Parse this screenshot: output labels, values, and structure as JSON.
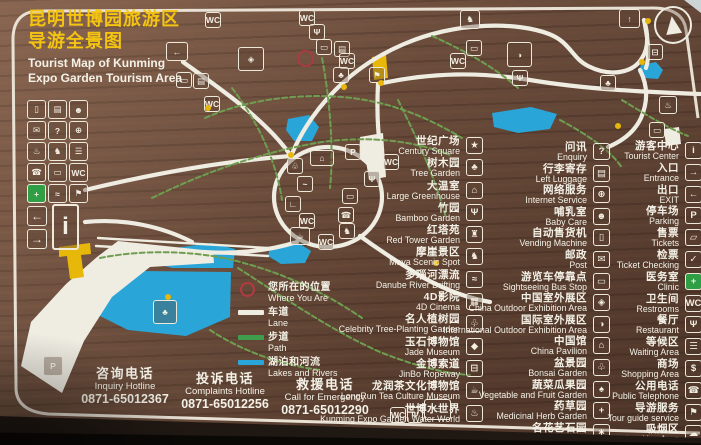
{
  "sign": {
    "title": {
      "zh1": "昆明世博园旅游区",
      "zh2": "导游全景图",
      "en1": "Tourist Map of Kunming",
      "en2": "Expo Garden Tourism Area"
    }
  },
  "legend": {
    "marker": {
      "zh": "您所在的位置",
      "en": "Where You Are"
    },
    "bars": [
      {
        "name": "legend-lane",
        "zh": "车道",
        "en": "Lane",
        "color": "#efece2"
      },
      {
        "name": "legend-path",
        "zh": "步道",
        "en": "Path",
        "color": "#3f9e4b"
      },
      {
        "name": "legend-lakes-rivers",
        "zh": "湖泊和河流",
        "en": "Lakes and Rivers",
        "color": "#2aa5d8"
      }
    ]
  },
  "attractions": [
    {
      "name": "poi-century-square",
      "zh": "世纪广场",
      "en": "Century Square",
      "icon": "century-square-icon",
      "glyph": "★"
    },
    {
      "name": "poi-tree-garden",
      "zh": "树木园",
      "en": "Tree Garden",
      "icon": "tree-icon",
      "glyph": "♣"
    },
    {
      "name": "poi-large-greenhouse",
      "zh": "大温室",
      "en": "Large Greenhouse",
      "icon": "greenhouse-icon",
      "glyph": "⌂"
    },
    {
      "name": "poi-bamboo-garden",
      "zh": "竹园",
      "en": "Bamboo Garden",
      "icon": "bamboo-icon",
      "glyph": "Ψ"
    },
    {
      "name": "poi-red-tower-garden",
      "zh": "红塔苑",
      "en": "Red Tower Garden",
      "icon": "tower-icon",
      "glyph": "♜"
    },
    {
      "name": "poi-moya-scenic-spot",
      "zh": "摩崖景区",
      "en": "Moya Scenic Spot",
      "icon": "horse-icon",
      "glyph": "♞"
    },
    {
      "name": "poi-danube-river-drifting",
      "zh": "多瑙河漂流",
      "en": "Danube River Drifting",
      "icon": "boat-icon",
      "glyph": "≈"
    },
    {
      "name": "poi-4d-cinema",
      "zh": "4D影院",
      "en": "4D Cinema",
      "icon": "cinema-icon",
      "glyph": "▦"
    },
    {
      "name": "poi-celebrity-tree-planting-garden",
      "zh": "名人植树园",
      "en": "Celebrity Tree-Planting Garden",
      "icon": "sapling-icon",
      "glyph": "♧"
    },
    {
      "name": "poi-jade-museum",
      "zh": "玉石博物馆",
      "en": "Jade Museum",
      "icon": "gem-icon",
      "glyph": "◆"
    },
    {
      "name": "poi-jinbo-ropeway",
      "zh": "金博索道",
      "en": "JinBo Ropeway",
      "icon": "cable-car-icon",
      "glyph": "⊟"
    },
    {
      "name": "poi-longrun-tea-culture-museum",
      "zh": "龙润茶文化博物馆",
      "en": "LongRun Tea Culture Museum",
      "icon": "teapot-icon",
      "glyph": "☕"
    },
    {
      "name": "poi-expo-water-world",
      "zh": "世博水世界",
      "en": "Kunming Expo Garden Water World",
      "icon": "hot-spring-icon",
      "glyph": "♨"
    }
  ],
  "services": [
    {
      "name": "svc-enquiry",
      "zh": "问讯",
      "en": "Enquiry",
      "icon": "question-icon",
      "glyph": "?"
    },
    {
      "name": "svc-left-luggage",
      "zh": "行李寄存",
      "en": "Left Luggage",
      "icon": "luggage-icon",
      "glyph": "▤"
    },
    {
      "name": "svc-internet-service",
      "zh": "网络服务",
      "en": "Internet Service",
      "icon": "globe-icon",
      "glyph": "⊕"
    },
    {
      "name": "svc-baby-care",
      "zh": "哺乳室",
      "en": "Baby Care",
      "icon": "baby-icon",
      "glyph": "☻"
    },
    {
      "name": "svc-vending-machine",
      "zh": "自动售货机",
      "en": "Vending Machine",
      "icon": "vending-icon",
      "glyph": "▯"
    },
    {
      "name": "svc-post",
      "zh": "邮政",
      "en": "Post",
      "icon": "envelope-icon",
      "glyph": "✉"
    },
    {
      "name": "svc-sightseeing-bus-stop",
      "zh": "游览车停靠点",
      "en": "Sightseeing Bus Stop",
      "icon": "bus-icon",
      "glyph": "▭"
    },
    {
      "name": "svc-china-outdoor-exhibition-area",
      "zh": "中国室外展区",
      "en": "China Outdoor Exhibition Area",
      "icon": "china-map-icon",
      "glyph": "◈"
    },
    {
      "name": "svc-international-outdoor-exhibition-area",
      "zh": "国际室外展区",
      "en": "International Outdoor Exhibition Area",
      "icon": "world-icon",
      "glyph": "◑"
    },
    {
      "name": "svc-china-pavilion",
      "zh": "中国馆",
      "en": "China Pavilion",
      "icon": "pavilion-icon",
      "glyph": "⌂"
    },
    {
      "name": "svc-bonsai-garden",
      "zh": "盆景园",
      "en": "Bonsai Garden",
      "icon": "bonsai-icon",
      "glyph": "♧"
    },
    {
      "name": "svc-vegetable-fruit-garden",
      "zh": "蔬菜瓜果园",
      "en": "Vegetable and Fruit Garden",
      "icon": "vegetable-icon",
      "glyph": "♠"
    },
    {
      "name": "svc-medicinal-herb-garden",
      "zh": "药草园",
      "en": "Medicinal Herb Garden",
      "icon": "herb-icon",
      "glyph": "+"
    },
    {
      "name": "svc-flowers-stone-crafts-garden",
      "zh": "名花艺石园",
      "en": "Flowers and Stone Crafts Garden",
      "icon": "flower-icon",
      "glyph": "∗"
    }
  ],
  "facilities": [
    {
      "name": "fac-tourist-center",
      "zh": "游客中心",
      "en": "Tourist Center",
      "icon": "information-icon",
      "glyph": "i"
    },
    {
      "name": "fac-entrance",
      "zh": "入口",
      "en": "Entrance",
      "icon": "entrance-arrow-icon",
      "glyph": "→"
    },
    {
      "name": "fac-exit",
      "zh": "出口",
      "en": "EXIT",
      "icon": "exit-arrow-icon",
      "glyph": "←"
    },
    {
      "name": "fac-parking",
      "zh": "停车场",
      "en": "Parking",
      "icon": "parking-icon",
      "glyph": "P"
    },
    {
      "name": "fac-tickets",
      "zh": "售票",
      "en": "Tickets",
      "icon": "ticket-icon",
      "glyph": "▱"
    },
    {
      "name": "fac-ticket-checking",
      "zh": "检票",
      "en": "Ticket Checking",
      "icon": "check-icon",
      "glyph": "✓"
    },
    {
      "name": "fac-clinic",
      "zh": "医务室",
      "en": "Clinic",
      "icon": "first-aid-icon",
      "glyph": "+",
      "box": "#2f9e44"
    },
    {
      "name": "fac-restrooms",
      "zh": "卫生间",
      "en": "Restrooms",
      "icon": "restroom-icon",
      "glyph": "WC"
    },
    {
      "name": "fac-restaurant",
      "zh": "餐厅",
      "en": "Restaurant",
      "icon": "fork-icon",
      "glyph": "Ψ"
    },
    {
      "name": "fac-waiting-area",
      "zh": "等候区",
      "en": "Waiting Area",
      "icon": "bench-icon",
      "glyph": "☰"
    },
    {
      "name": "fac-shopping-area",
      "zh": "商场",
      "en": "Shopping Area",
      "icon": "shopping-icon",
      "glyph": "$"
    },
    {
      "name": "fac-public-telephone",
      "zh": "公用电话",
      "en": "Public Telephone",
      "icon": "telephone-icon",
      "glyph": "☎"
    },
    {
      "name": "fac-tour-guide-service",
      "zh": "导游服务",
      "en": "Tour guide service",
      "icon": "guide-flag-icon",
      "glyph": "⚑"
    },
    {
      "name": "fac-smoking-area",
      "zh": "吸烟区",
      "en": "Smoking Area",
      "icon": "smoke-icon",
      "glyph": "☁"
    }
  ],
  "hotlines": [
    {
      "name": "inquiry-hotline",
      "zh": "咨询电话",
      "en": "Inquiry Hotline",
      "phone": "0871-65012367",
      "x": 58,
      "y": 4
    },
    {
      "name": "complaints-hotline",
      "zh": "投诉电话",
      "en": "Complaints Hotline",
      "phone": "0871-65012256",
      "x": 158,
      "y": 9
    },
    {
      "name": "emergency-hotline",
      "zh": "救援电话",
      "en": "Call for Emergency",
      "phone": "0871-65012290",
      "x": 258,
      "y": 15
    }
  ],
  "left_grid": [
    {
      "name": "grid-vending-machine-icon",
      "glyph": "▯"
    },
    {
      "name": "grid-left-luggage-icon",
      "glyph": "▤"
    },
    {
      "name": "grid-baby-care-icon",
      "glyph": "☻"
    },
    {
      "name": "grid-post-icon",
      "glyph": "✉"
    },
    {
      "name": "grid-enquiry-icon",
      "glyph": "?"
    },
    {
      "name": "grid-internet-icon",
      "glyph": "⊕"
    },
    {
      "name": "grid-drinking-water-icon",
      "glyph": "♨"
    },
    {
      "name": "grid-scenic-spot-icon",
      "glyph": "♞"
    },
    {
      "name": "grid-rest-area-icon",
      "glyph": "☰"
    },
    {
      "name": "grid-telephone-icon",
      "glyph": "☎"
    },
    {
      "name": "grid-bus-station-icon",
      "glyph": "▭"
    },
    {
      "name": "grid-restroom-icon",
      "glyph": "WC"
    },
    {
      "name": "grid-first-aid-icon",
      "glyph": "+",
      "box": "#2f9e44"
    },
    {
      "name": "grid-water-icon",
      "glyph": "≈"
    },
    {
      "name": "grid-tour-guide-icon",
      "glyph": "⚑"
    }
  ],
  "left_grid_special": {
    "exit": "←",
    "info": "i",
    "entrance": "→"
  },
  "map": {
    "icons": [
      {
        "name": "map-restroom-icon",
        "glyph": "WC",
        "x": 205,
        "y": 12
      },
      {
        "name": "map-exit-icon",
        "glyph": "←",
        "x": 166,
        "y": 42,
        "w": 22,
        "h": 19
      },
      {
        "name": "map-bus-stop-icon",
        "glyph": "▭",
        "x": 176,
        "y": 72
      },
      {
        "name": "map-sign-icon",
        "glyph": "▤",
        "x": 193,
        "y": 73
      },
      {
        "name": "map-restroom-icon",
        "glyph": "WC",
        "x": 204,
        "y": 96
      },
      {
        "name": "map-china-garden-icon",
        "glyph": "◈",
        "x": 238,
        "y": 47,
        "w": 26,
        "h": 24
      },
      {
        "name": "map-restroom-icon",
        "glyph": "WC",
        "x": 299,
        "y": 10
      },
      {
        "name": "map-restaurant-icon",
        "glyph": "Ψ",
        "x": 309,
        "y": 24
      },
      {
        "name": "map-bus-stop-icon",
        "glyph": "▭",
        "x": 316,
        "y": 39
      },
      {
        "name": "map-sign-icon",
        "glyph": "▤",
        "x": 334,
        "y": 41
      },
      {
        "name": "map-restroom-icon",
        "glyph": "WC",
        "x": 339,
        "y": 53
      },
      {
        "name": "map-tree-icon",
        "glyph": "♣",
        "x": 333,
        "y": 67
      },
      {
        "name": "map-golf-icon",
        "glyph": "⚑",
        "x": 369,
        "y": 67
      },
      {
        "name": "map-moya-horse-icon",
        "glyph": "♞",
        "x": 460,
        "y": 10,
        "w": 20,
        "h": 19
      },
      {
        "name": "map-bus-stop-icon",
        "glyph": "▭",
        "x": 466,
        "y": 40
      },
      {
        "name": "map-restroom-icon",
        "glyph": "WC",
        "x": 450,
        "y": 53
      },
      {
        "name": "map-globe-icon",
        "glyph": "◑",
        "x": 507,
        "y": 42,
        "w": 25,
        "h": 25
      },
      {
        "name": "map-restaurant-icon",
        "glyph": "Ψ",
        "x": 512,
        "y": 70
      },
      {
        "name": "map-exit-icon",
        "glyph": "↑",
        "x": 619,
        "y": 9,
        "w": 21,
        "h": 19
      },
      {
        "name": "map-ropeway-icon",
        "glyph": "⊟",
        "x": 647,
        "y": 44
      },
      {
        "name": "map-hot-spring-icon",
        "glyph": "♨",
        "x": 659,
        "y": 96,
        "w": 18,
        "h": 18
      },
      {
        "name": "map-bus-stop-icon",
        "glyph": "▭",
        "x": 649,
        "y": 122
      },
      {
        "name": "map-parking-icon",
        "glyph": "P",
        "x": 345,
        "y": 144
      },
      {
        "name": "map-restroom-icon",
        "glyph": "WC",
        "x": 383,
        "y": 154
      },
      {
        "name": "map-restaurant-icon",
        "glyph": "Ψ",
        "x": 364,
        "y": 171
      },
      {
        "name": "map-greenhouse-icon",
        "glyph": "⌂",
        "x": 310,
        "y": 150,
        "w": 24,
        "h": 16
      },
      {
        "name": "map-bonsai-icon",
        "glyph": "♧",
        "x": 287,
        "y": 158
      },
      {
        "name": "map-bird-icon",
        "glyph": "~",
        "x": 297,
        "y": 176
      },
      {
        "name": "map-shoe-icon",
        "glyph": "∟",
        "x": 285,
        "y": 196
      },
      {
        "name": "map-restroom-icon",
        "glyph": "WC",
        "x": 299,
        "y": 213
      },
      {
        "name": "map-bus-stop-icon",
        "glyph": "▭",
        "x": 342,
        "y": 188
      },
      {
        "name": "map-telephone-icon",
        "glyph": "☎",
        "x": 338,
        "y": 207
      },
      {
        "name": "map-teahouse-icon",
        "glyph": "☕",
        "x": 290,
        "y": 227,
        "w": 20,
        "h": 18
      },
      {
        "name": "map-restroom-icon",
        "glyph": "WC",
        "x": 318,
        "y": 234
      },
      {
        "name": "map-rock-icon",
        "glyph": "♞",
        "x": 339,
        "y": 223
      },
      {
        "name": "map-palm-tree-icon",
        "glyph": "♣",
        "x": 153,
        "y": 300,
        "w": 24,
        "h": 24
      },
      {
        "name": "map-parking-icon",
        "glyph": "P",
        "x": 43,
        "y": 356,
        "w": 20,
        "h": 20
      },
      {
        "name": "map-restroom-icon",
        "glyph": "WC",
        "x": 390,
        "y": 407
      },
      {
        "name": "map-restaurant-icon",
        "glyph": "Ψ",
        "x": 407,
        "y": 407
      },
      {
        "name": "map-tour-bus-icon",
        "glyph": "▭",
        "x": 424,
        "y": 399,
        "w": 27,
        "h": 21
      },
      {
        "name": "map-tree-icon",
        "glyph": "♣",
        "x": 600,
        "y": 75
      }
    ],
    "dots": [
      {
        "x": 288,
        "y": 152
      },
      {
        "x": 645,
        "y": 18
      },
      {
        "x": 341,
        "y": 84
      },
      {
        "x": 378,
        "y": 80
      },
      {
        "x": 165,
        "y": 294
      },
      {
        "x": 615,
        "y": 123
      },
      {
        "x": 433,
        "y": 260
      },
      {
        "x": 639,
        "y": 59
      },
      {
        "x": 205,
        "y": 105
      }
    ]
  },
  "colors": {
    "board_brown": "#6f4e3c",
    "title_yellow": "#f4c411",
    "text_white": "#f4f1e7",
    "road_white": "#efece2",
    "path_green": "#3f9e4b",
    "water_blue": "#2aa5d8",
    "marker_yellow": "#e7b70a",
    "you_are_here_red": "#b23a42",
    "first_aid_green": "#2f9e44"
  }
}
